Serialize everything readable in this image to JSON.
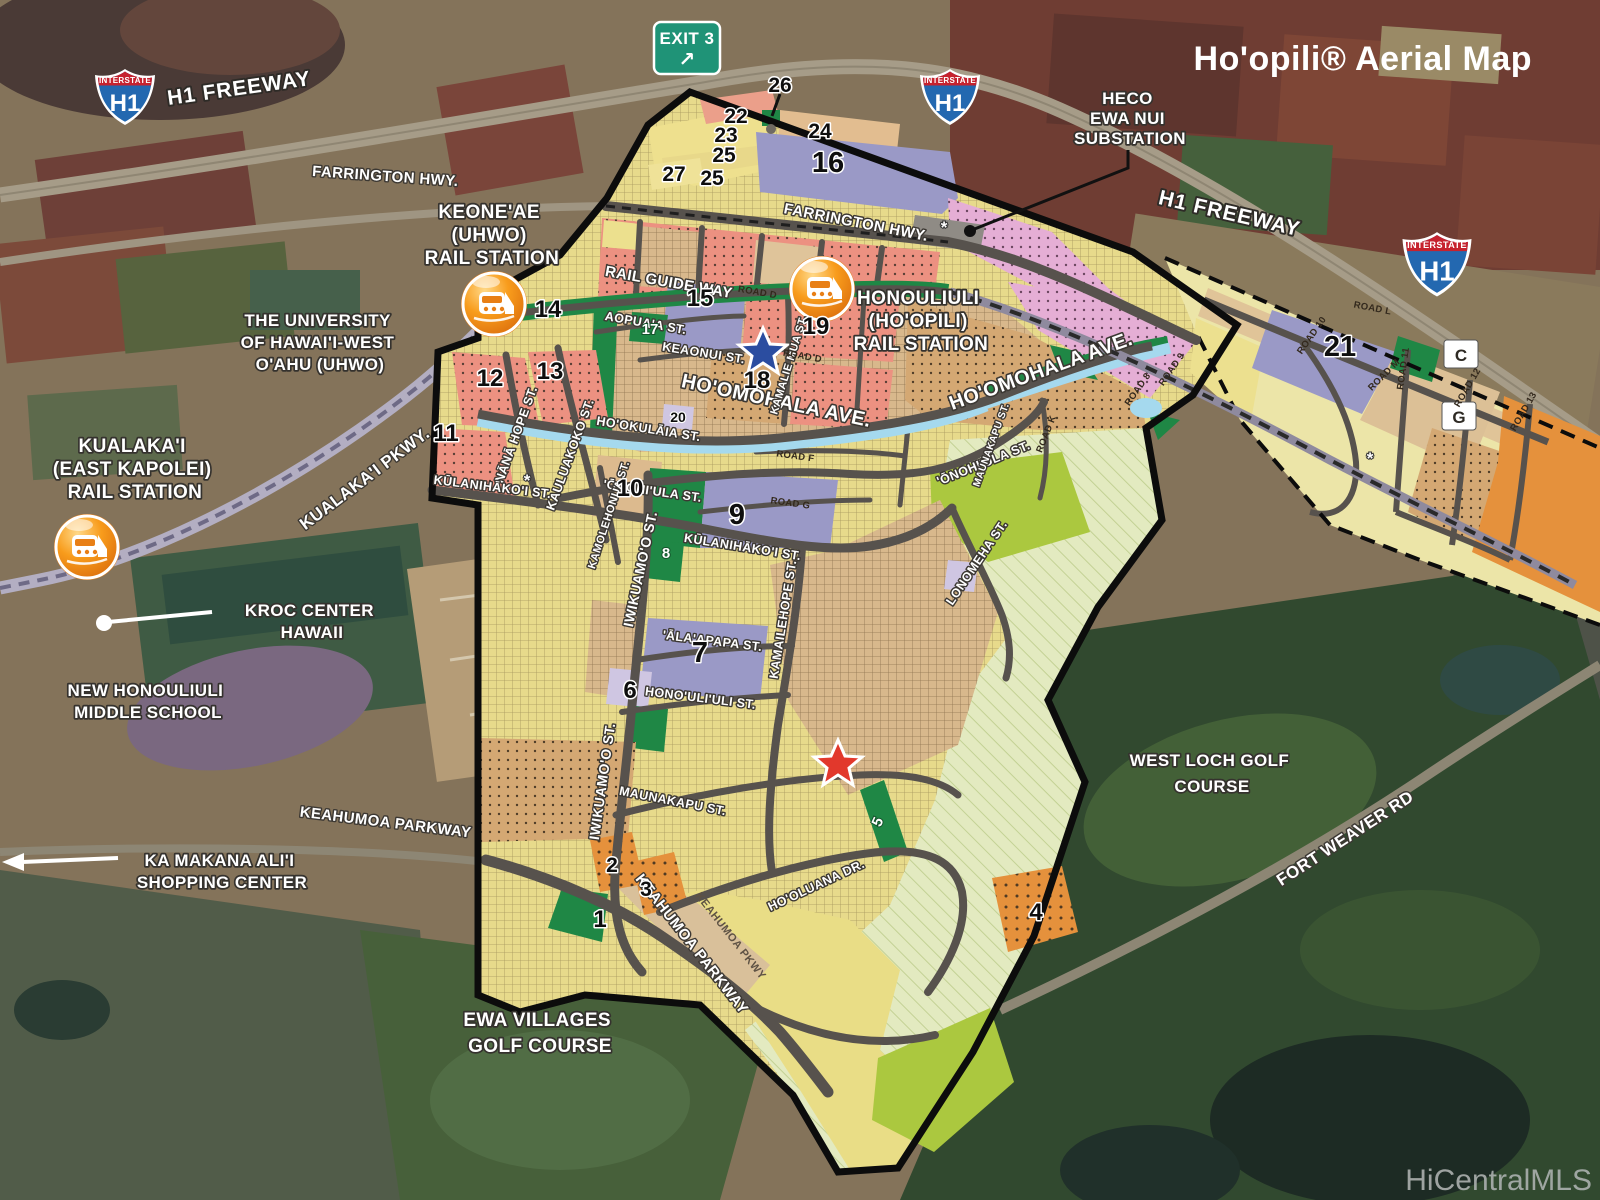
{
  "title": "Ho'opili® Aerial Map",
  "watermark": "HiCentralMLS",
  "signs": {
    "exit": "EXIT 3",
    "arrow": "↗",
    "interstate": "INTERSTATE",
    "h1": "H1"
  },
  "highways": {
    "h1_left": "H1 FREEWAY",
    "h1_right": "H1 FREEWAY",
    "farrington_out": "FARRINGTON HWY.",
    "farrington_in": "FARRINGTON HWY.",
    "kualakai": "KUALAKA'I PKWY.",
    "fort_weaver": "FORT WEAVER RD",
    "keahumoa_out": "KEAHUMOA PARKWAY",
    "keahumoa_in": "KEAHUMOA PARKWAY",
    "keahumoa_sm": "KEAHUMOA PKWY"
  },
  "landmarks": {
    "keoneae": [
      "KEONE'AE",
      "(UHWO)",
      "RAIL STATION"
    ],
    "honouliuli": [
      "HONOULIULI",
      "(HO'OPILI)",
      "RAIL STATION"
    ],
    "kualakai_station": [
      "KUALAKA'I",
      "(EAST KAPOLEI)",
      "RAIL STATION"
    ],
    "heco": [
      "HECO",
      "EWA NUI",
      "SUBSTATION"
    ],
    "uhwo": [
      "THE UNIVERSITY",
      "OF HAWAI'I-WEST",
      "O'AHU (UHWO)"
    ],
    "kroc": [
      "KROC CENTER",
      "HAWAII"
    ],
    "school": [
      "NEW HONOULIULI",
      "MIDDLE SCHOOL"
    ],
    "kamakana": [
      "KA MAKANA ALI'I",
      "SHOPPING CENTER"
    ],
    "ewa": [
      "EWA VILLAGES",
      "GOLF COURSE"
    ],
    "westloch": [
      "WEST LOCH GOLF",
      "COURSE"
    ]
  },
  "streets": {
    "rail_guide": "RAIL GUIDE WAY",
    "hoomohala_a": "HO'OMOHALA AVE.",
    "hoomohala_b": "HO'OMOHALA AVE.",
    "aopuaa": "AOPUA'A ST.",
    "keaonui": "KEAONUI ST.",
    "nana_hope": "NĀNĀ HOPE ST.",
    "kauluakoko": "KAULUAKOKO ST.",
    "hookulaia": "HO'OKULĀIA ST.",
    "kulanihakoi_a": "KŪLANIHĀKO'I ST.",
    "kulanihakoi_b": "KŪLANIHĀKO'I ST.",
    "onohiula_a": "'ŌNOHI'ULA ST.",
    "onohiula_b": "'ŌNOHI'ULA ST.",
    "kamolehonua": "KAMOLEHONUA ST.",
    "iwikuamoo_a": "IWIKUAMO'O ST.",
    "iwikuamoo_b": "IWIKUAMO'O ST.",
    "kamailehope": "KAMAILEHOPE ST.",
    "kamalie_mua": "KAMALIE MUA ST.",
    "lonomeha": "LONOMEHA ST.",
    "alaapapa": "'ĀLA'APAPA ST.",
    "honouliuli_st": "HONO'ULI'ULI ST.",
    "maunakapu_a": "MAUNAKAPU ST.",
    "maunakapu_b": "MAUNAKAPU ST.",
    "hooluana": "HO'OLUANA DR."
  },
  "minor_roads": {
    "d1": "ROAD D",
    "d2": "ROAD D",
    "f": "ROAD F",
    "g": "ROAD G",
    "k": "ROAD K",
    "r8": "ROAD 8",
    "r9": "ROAD 9",
    "l": "ROAD L",
    "r10": "ROAD 10",
    "m": "ROAD M",
    "r11": "ROAD 11",
    "r12": "ROAD 12",
    "r13": "ROAD 13"
  },
  "parcels": {
    "n1": "1",
    "n2": "2",
    "n3": "3",
    "n4": "4",
    "n5": "5",
    "n6": "6",
    "n7": "7",
    "n8": "8",
    "n9": "9",
    "n10": "10",
    "n11": "11",
    "n12": "12",
    "n13": "13",
    "n14": "14",
    "n15": "15",
    "n16": "16",
    "n17": "17",
    "n18": "18",
    "n19": "19",
    "n20": "20",
    "n21": "21",
    "n22": "22",
    "n23": "23",
    "n24": "24",
    "n25": "25",
    "n25b": "25",
    "n26": "26",
    "n27": "27",
    "c": "C",
    "g": "G"
  },
  "symbols": {
    "asterisk": "*"
  },
  "colors": {
    "boundary": "#0c0c0c",
    "road": "#57524d",
    "stream": "#a5d9ee",
    "park_green": "#1f8745",
    "residential_salmon": "#ec9181",
    "commercial_purple": "#9a99c6",
    "school_lavender": "#cfc6e2",
    "mixed_tan": "#d8b88c",
    "agriculture_yellow": "#e7da8b",
    "open_lime": "#abc83f",
    "industrial_pink": "#e5aed5",
    "business_orange": "#e5913c",
    "station_orange": "#f89c1c",
    "exit_sign_green": "#1f9377",
    "shield_red": "#c6222e",
    "shield_blue": "#2368b0"
  }
}
